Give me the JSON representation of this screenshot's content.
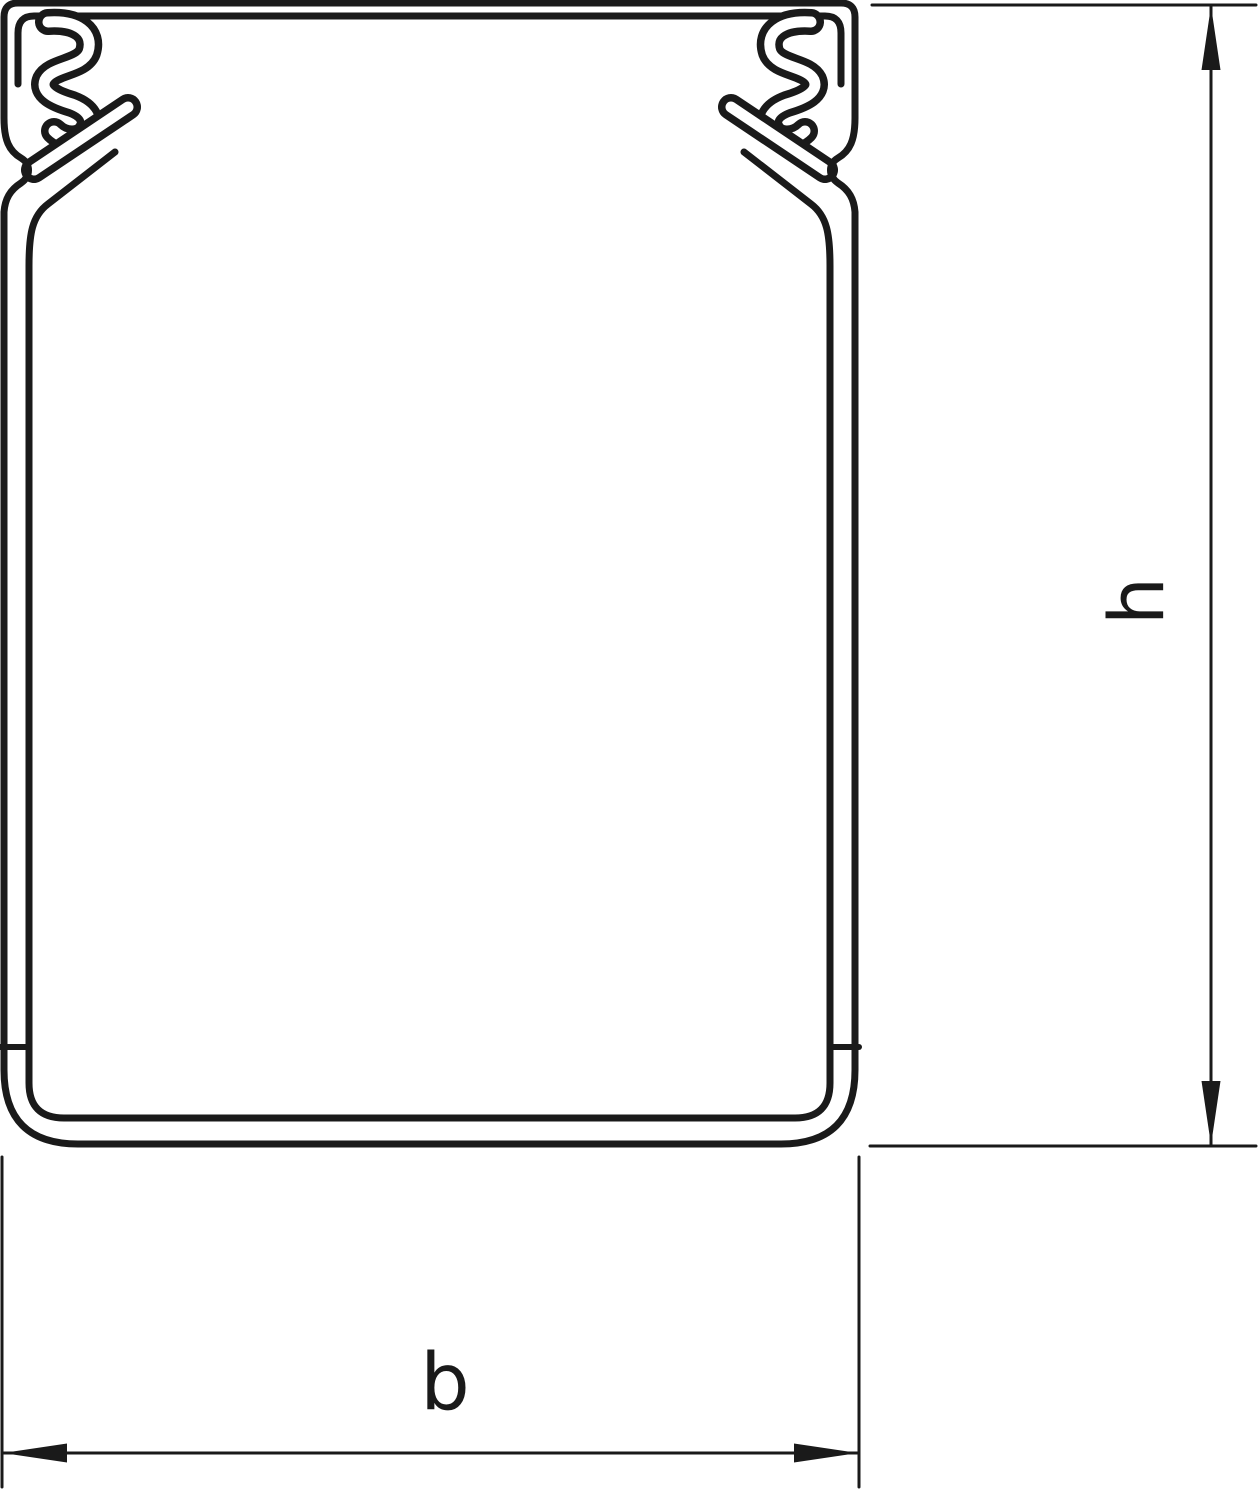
{
  "figure": {
    "description": "Cross-section technical line drawing of a cable trunking (wiring duct) profile with cover-clip spring edges, shown with height and width dimension lines",
    "line_color": "#1a1a1a",
    "background_color": "#ffffff"
  },
  "dimensions": {
    "height": {
      "label": "h"
    },
    "width": {
      "label": "b"
    }
  }
}
